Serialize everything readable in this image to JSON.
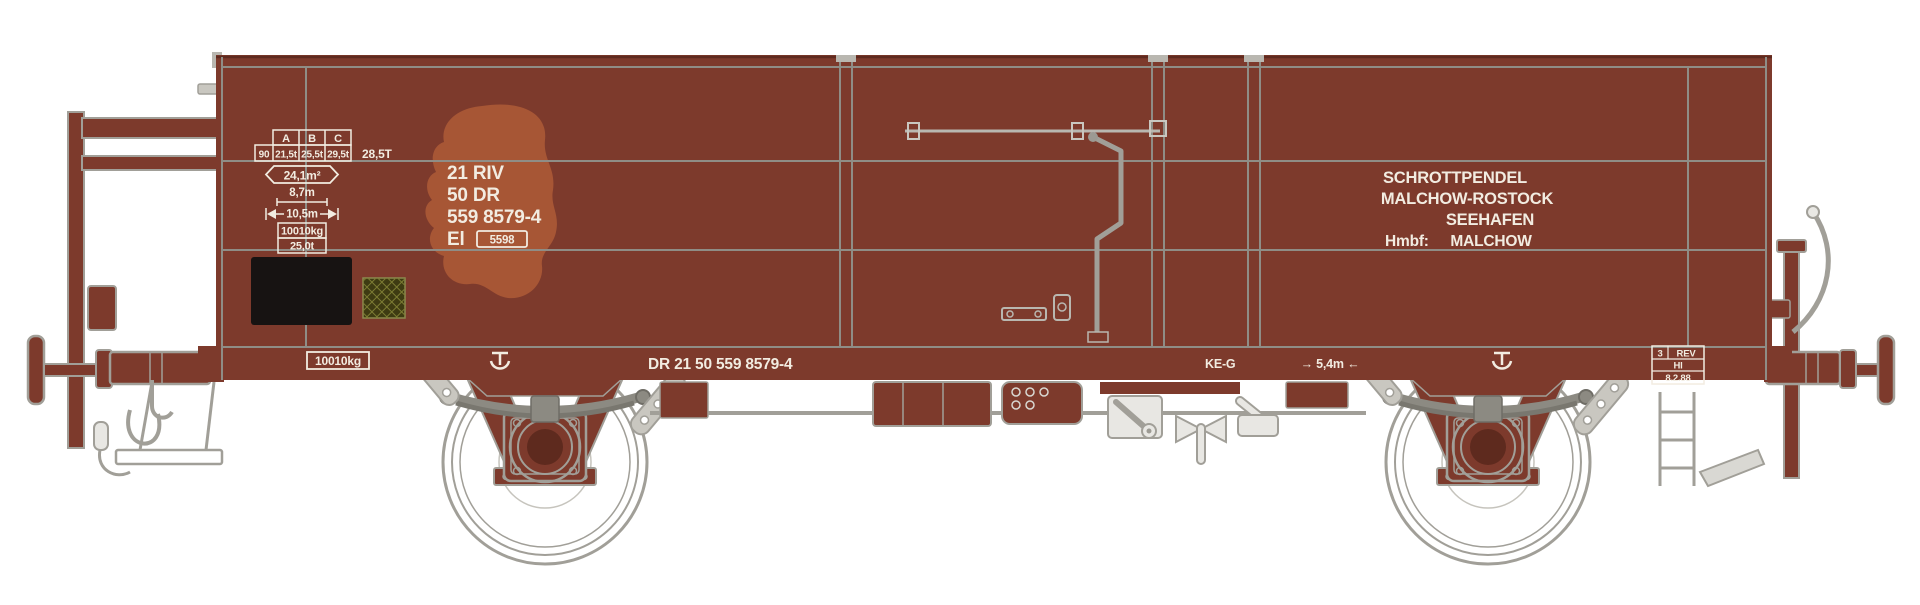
{
  "colors": {
    "body": "#7d3a2c",
    "seam": "#8f8d86",
    "outline": "#a19f98",
    "metal": "#e8e7e3",
    "spring": "#8c8a82",
    "rust": "#a75635",
    "text": "#f2ece1",
    "patch_black": "#171312",
    "patch_green": "#3e3b12"
  },
  "markings": {
    "load_table": {
      "headers": [
        "A",
        "B",
        "C"
      ],
      "row": [
        "90",
        "21,5t",
        "25,5t",
        "29,5t"
      ],
      "note": "28,5T"
    },
    "dimensions": {
      "floor_area": "24,1m²",
      "inner_length": "8,7m",
      "length_over_buffers": "10,5m",
      "tare_weight": "10010kg",
      "load_limit": "25,0t"
    },
    "number_block": {
      "line1": "21 RIV",
      "line2": "50 DR",
      "line3": "559  8579-4",
      "class_letters": "El",
      "class_number": "5598"
    },
    "route_board": {
      "line1": "SCHROTTPENDEL",
      "line2": "MALCHOW-ROSTOCK",
      "line3": "SEEHAFEN",
      "line4_label": "Hmbf:",
      "line4_value": "MALCHOW"
    },
    "solebar": {
      "tare_box": "10010kg",
      "full_number": "DR 21 50 559 8579-4",
      "brake_type": "KE-G",
      "axle_note": "→ 5,4m ←",
      "rev_box": {
        "cell1": "3",
        "cell2": "REV",
        "row2": "Hl",
        "row3": "8.2.88"
      }
    }
  }
}
